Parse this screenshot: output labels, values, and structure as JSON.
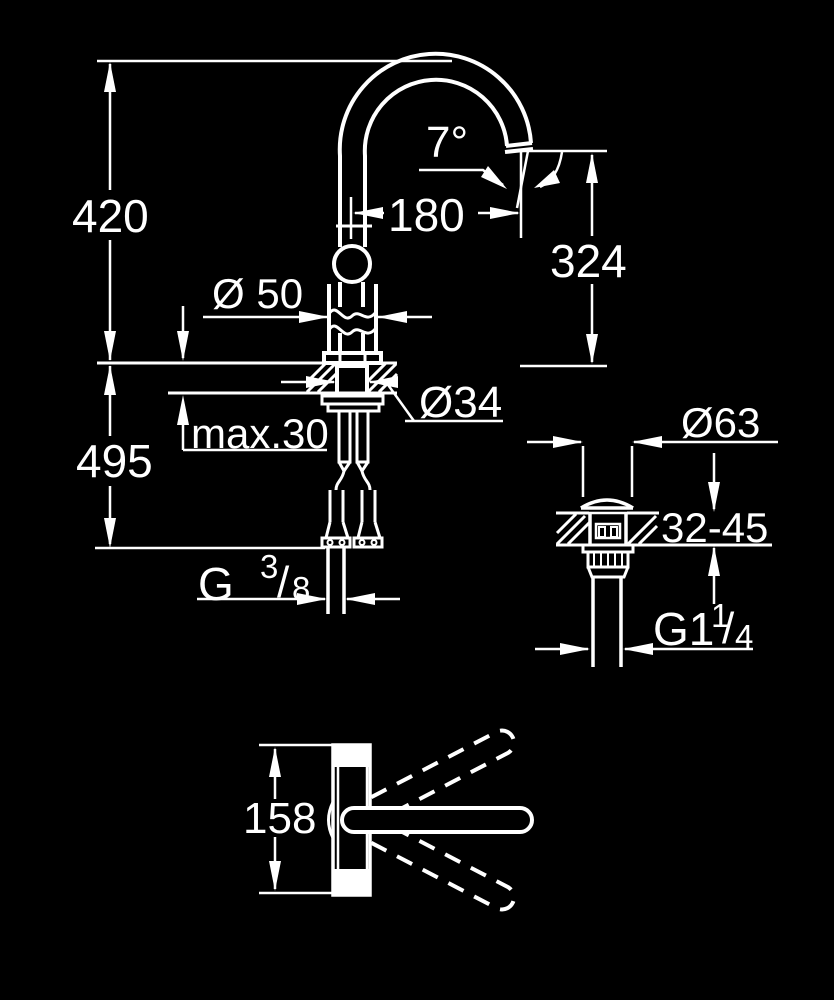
{
  "title": "Faucet technical dimension drawing",
  "colors": {
    "background": "#000000",
    "line": "#ffffff"
  },
  "labels": {
    "spout_height": "420",
    "below_counter_height": "495",
    "body_diameter": "Ø 50",
    "max_deck_thickness": "max.30",
    "shank_diameter": "Ø34",
    "spout_reach": "180",
    "spout_angle": "7°",
    "spout_outlet_height": "324",
    "drain_flange_diameter": "Ø63",
    "drain_deck_thickness_range": "32-45",
    "swivel_body_width": "158",
    "supply_thread": {
      "base": "G",
      "sup": "3",
      "slash": "/",
      "sub": "8"
    },
    "drain_thread": {
      "base": "G1",
      "sup": "1",
      "slash": "/",
      "sub": "4"
    }
  }
}
